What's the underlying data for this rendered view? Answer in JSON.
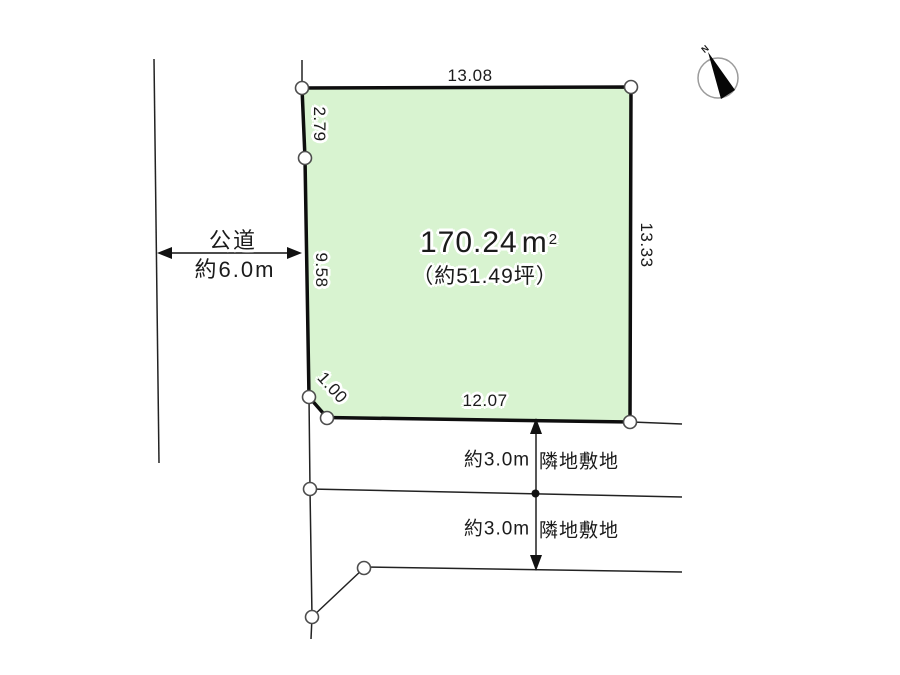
{
  "plot": {
    "area_value": "170.24",
    "area_unit": "m",
    "area_unit_sup": "2",
    "tsubo": "（約51.49坪）",
    "fill_color": "#d8f3d0"
  },
  "dimensions": {
    "top": "13.08",
    "upper_left": "2.79",
    "left": "9.58",
    "lower_left": "1.00",
    "bottom": "12.07",
    "right": "13.33"
  },
  "road": {
    "name": "公道",
    "width": "約6.0m"
  },
  "neighbors": [
    {
      "distance": "約3.0m",
      "label": "隣地敷地"
    },
    {
      "distance": "約3.0m",
      "label": "隣地敷地"
    }
  ],
  "compass": {
    "label": "N"
  }
}
